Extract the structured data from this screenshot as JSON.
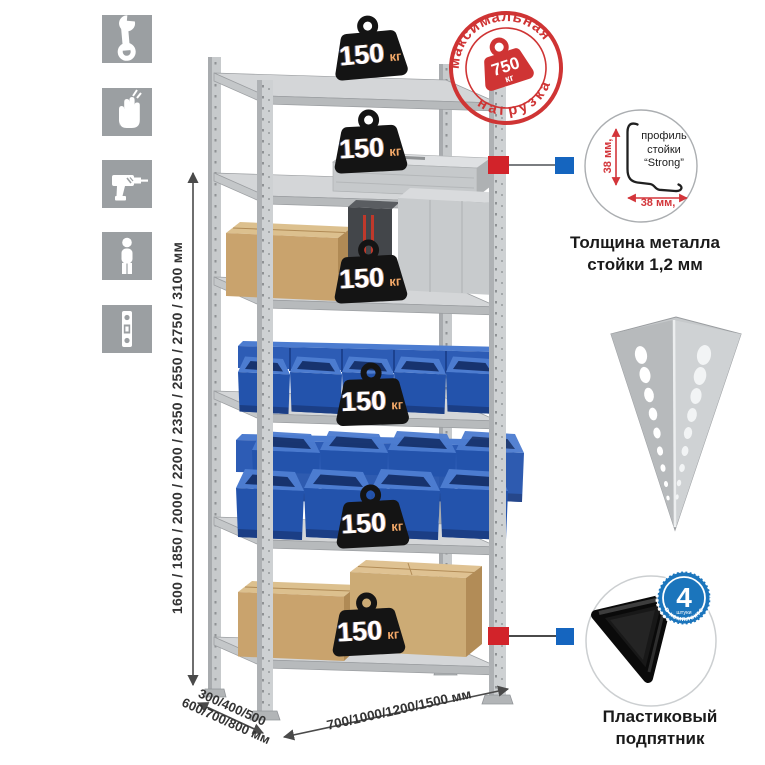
{
  "assembly": {
    "icons": [
      {
        "name": "wrench-icon"
      },
      {
        "name": "gloves-icon"
      },
      {
        "name": "drill-icon"
      },
      {
        "name": "person-icon"
      },
      {
        "name": "level-icon"
      }
    ],
    "tile_color": "#9b9fa2"
  },
  "dimensions": {
    "height": "1600 / 1850 / 2000 / 2200 / 2350 / 2550 / 2750 / 3100 мм",
    "depth_line1": "300/400/500",
    "depth_line2": "600/700/800 мм",
    "width": "700/1000/1200/1500 мм"
  },
  "shelf_loads": {
    "items": [
      {
        "value": "150",
        "unit": "кг"
      },
      {
        "value": "150",
        "unit": "кг"
      },
      {
        "value": "150",
        "unit": "кг"
      },
      {
        "value": "150",
        "unit": "кг"
      },
      {
        "value": "150",
        "unit": "кг"
      },
      {
        "value": "150",
        "unit": "кг"
      }
    ]
  },
  "max_load": {
    "arc_top": "максимальная",
    "arc_bottom": "нагрузка",
    "value": "750",
    "unit": "кг",
    "color": "#cf3434"
  },
  "profile": {
    "label_line1": "профиль",
    "label_line2": "стойки",
    "label_line3": "“Strong”",
    "dim_vertical": "38 мм,",
    "dim_horizontal": "38 мм,",
    "caption_line1": "Толщина металла",
    "caption_line2": "стойки 1,2 мм"
  },
  "foot": {
    "badge_value": "4",
    "badge_small": "штуки",
    "badge_arc": "в комплекте",
    "badge_color": "#1b75bc",
    "caption_line1": "Пластиковый",
    "caption_line2": "подпятник"
  },
  "colors": {
    "stamp_red": "#cf3434",
    "marker_red": "#d2232a",
    "marker_blue": "#1565bf",
    "bin_blue": "#2353ac",
    "rack_gray": "#ced1d3"
  }
}
